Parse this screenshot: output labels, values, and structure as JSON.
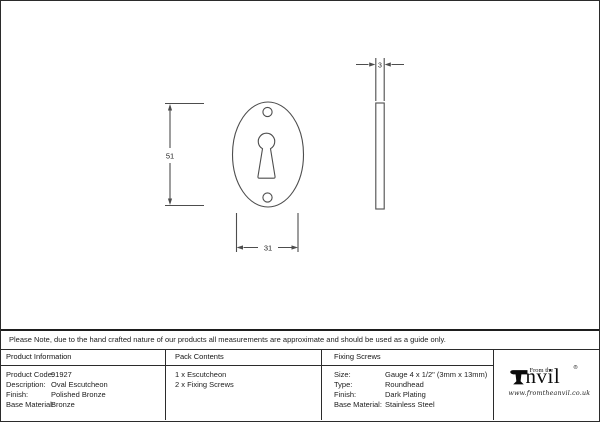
{
  "drawing": {
    "description": "Technical line drawing of an oval escutcheon: front view with keyhole and two screw holes, plus thin side profile view",
    "dim_height": "51",
    "dim_width": "31",
    "dim_thickness": "3"
  },
  "note": "Please Note, due to the hand crafted nature of our products all measurements are approximate and should be used as a guide only.",
  "table": {
    "product_information": {
      "header": "Product Information",
      "rows": [
        {
          "label": "Product Code:",
          "value": "91927"
        },
        {
          "label": "Description:",
          "value": "Oval Escutcheon"
        },
        {
          "label": "Finish:",
          "value": "Polished Bronze"
        },
        {
          "label": "Base Material:",
          "value": "Bronze"
        }
      ]
    },
    "pack_contents": {
      "header": "Pack Contents",
      "items": [
        "1 x Escutcheon",
        "2 x Fixing Screws"
      ]
    },
    "fixing_screws": {
      "header": "Fixing Screws",
      "rows": [
        {
          "label": "Size:",
          "value": "Gauge 4 x 1/2\" (3mm x 13mm)"
        },
        {
          "label": "Type:",
          "value": "Roundhead"
        },
        {
          "label": "Finish:",
          "value": "Dark Plating"
        },
        {
          "label": "Base Material:",
          "value": "Stainless Steel"
        }
      ]
    }
  },
  "logo": {
    "from_the": "From the",
    "brand": "nvil",
    "registered": "®",
    "website": "www.fromtheanvil.co.uk"
  },
  "colors": {
    "line": "#4d4d4d",
    "border": "#2b2b2b",
    "text": "#1c1c1c",
    "background": "#ffffff"
  }
}
